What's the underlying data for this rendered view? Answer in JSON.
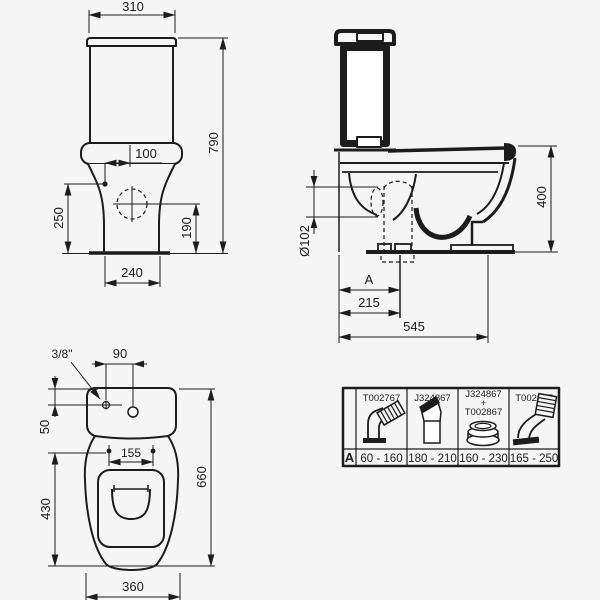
{
  "front_view": {
    "dim_width_top": "310",
    "dim_height": "790",
    "dim_inlet_offset": "100",
    "dim_inlet_height": "250",
    "dim_hole_height": "190",
    "dim_base_width": "240"
  },
  "side_view": {
    "dim_height": "400",
    "dim_outlet_diameter": "Ø102",
    "dim_rough_in": "A",
    "dim_outlet_center": "215",
    "dim_depth": "545"
  },
  "plan_view": {
    "dim_inlet_thread": "3/8\"",
    "dim_hole_spacing": "90",
    "dim_inlet_offset": "50",
    "dim_hinge_spacing": "155",
    "dim_bowl_length": "430",
    "dim_total_length": "660",
    "dim_bowl_width": "360"
  },
  "accessories_table": {
    "row_label": "A",
    "columns": [
      {
        "part": "T002767",
        "range": "60 - 160",
        "icon": "p-trap-elbow-connector-icon"
      },
      {
        "part": "J324867",
        "range": "180 - 210",
        "icon": "angled-outlet-connector-icon"
      },
      {
        "part": "J324867",
        "plus": "+",
        "part2": "T002867",
        "range": "160 - 230",
        "icon": "seal-ring-icon"
      },
      {
        "part": "T002667",
        "range": "165 - 250",
        "icon": "flexible-outlet-connector-icon"
      }
    ]
  },
  "colors": {
    "line": "#1c1c1c",
    "background": "#f5f5f5"
  }
}
